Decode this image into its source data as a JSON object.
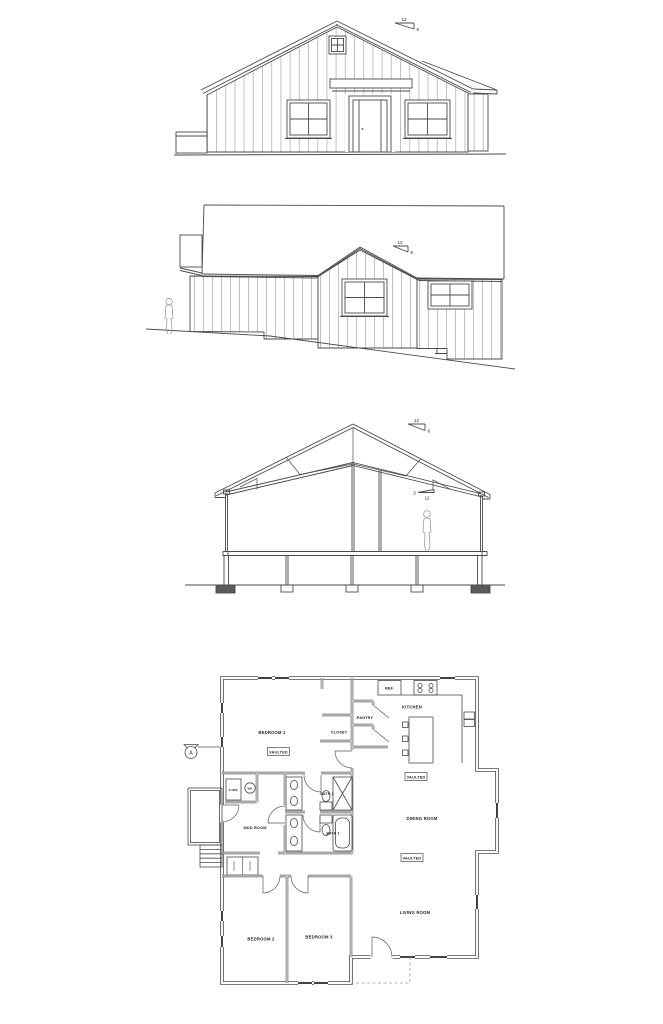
{
  "page": {
    "background": "#ffffff",
    "colors": {
      "line": "#4a4a4a",
      "wall": "#4f4f4f",
      "window_fill": "#2e2e2e",
      "batten": "#a8a8a8",
      "figure": "#9a9a9a"
    }
  },
  "drawings": {
    "front_elevation": {
      "roof_pitch": {
        "rise": "12",
        "run": "6"
      }
    },
    "side_elevation": {
      "roof_pitch": {
        "rise": "12",
        "run": "6"
      }
    },
    "building_section": {
      "roof_pitch": {
        "rise": "12",
        "run": "6"
      },
      "ceiling_pitch": {
        "rise": "3",
        "run": "12"
      }
    },
    "floor_plan": {
      "section_marker": "A",
      "rooms": {
        "bedroom1": "BEDROOM 1",
        "bedroom2": "BEDROOM 2",
        "bedroom3": "BEDROOM 3",
        "closet": "CLOSET",
        "pantry": "PANTRY",
        "kitchen": "KITCHEN",
        "dining_room": "DINING ROOM",
        "living_room": "LIVING ROOM",
        "mud_room": "MUD ROOM",
        "bath1": "BATH 1",
        "bath2": "BATH 2"
      },
      "tags": {
        "vaulted": "VAULTED",
        "ref": "REF.",
        "furn": "FURN.",
        "wh": "WH"
      }
    }
  }
}
